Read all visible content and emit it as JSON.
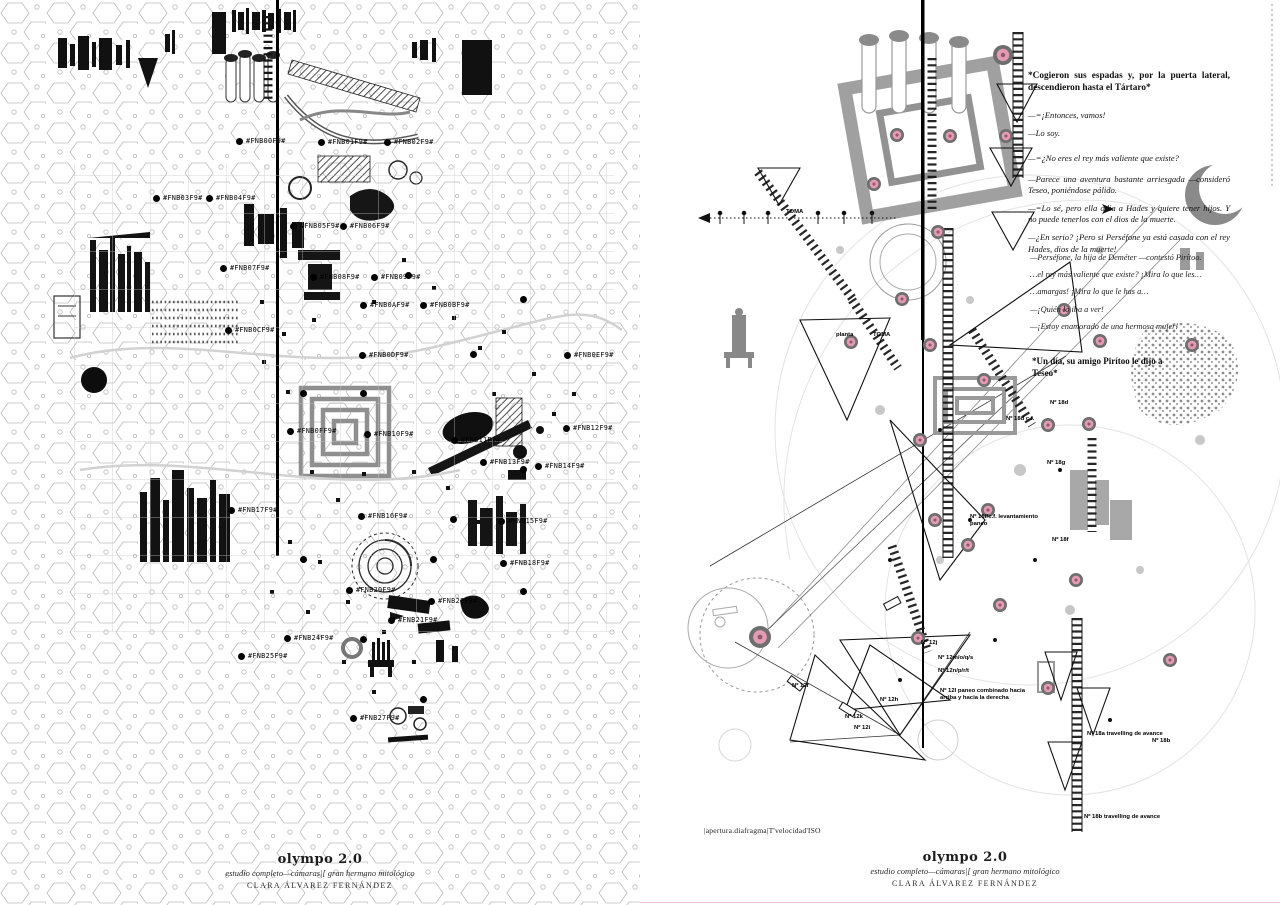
{
  "left_page": {
    "title": "olympo 2.0",
    "subtitle": "estudio completo—cámaras|[ gran hermano mitológico",
    "author": "CLARA ÁLVAREZ FERNÁNDEZ",
    "labels": [
      {
        "t": "#FNB00F9#",
        "x": 246,
        "y": 137
      },
      {
        "t": "#FNB01F9#",
        "x": 328,
        "y": 138
      },
      {
        "t": "#FNB02F9#",
        "x": 394,
        "y": 138
      },
      {
        "t": "#FNB03F9#",
        "x": 163,
        "y": 194
      },
      {
        "t": "#FNB04F9#",
        "x": 216,
        "y": 194
      },
      {
        "t": "#FNB05F9#",
        "x": 300,
        "y": 222
      },
      {
        "t": "#FNB06F9#",
        "x": 350,
        "y": 222
      },
      {
        "t": "#FNB07F9#",
        "x": 230,
        "y": 264
      },
      {
        "t": "#FNB08F9#",
        "x": 320,
        "y": 273
      },
      {
        "t": "#FNB09F9#",
        "x": 381,
        "y": 273
      },
      {
        "t": "#FNB0AF9#",
        "x": 370,
        "y": 301
      },
      {
        "t": "#FNB0BF9#",
        "x": 430,
        "y": 301
      },
      {
        "t": "#FNB0CF9#",
        "x": 235,
        "y": 326
      },
      {
        "t": "#FNB0DF9#",
        "x": 369,
        "y": 351
      },
      {
        "t": "#FNB0EF9#",
        "x": 574,
        "y": 351
      },
      {
        "t": "#FNB0FF9#",
        "x": 297,
        "y": 427
      },
      {
        "t": "#FNB10F9#",
        "x": 374,
        "y": 430
      },
      {
        "t": "#FNB11F9#",
        "x": 461,
        "y": 436
      },
      {
        "t": "#FNB12F9#",
        "x": 573,
        "y": 424
      },
      {
        "t": "#FNB13F9#",
        "x": 490,
        "y": 458
      },
      {
        "t": "#FNB14F9#",
        "x": 545,
        "y": 462
      },
      {
        "t": "#FNB15F9#",
        "x": 508,
        "y": 517
      },
      {
        "t": "#FNB16F9#",
        "x": 368,
        "y": 512
      },
      {
        "t": "#FNB17F9#",
        "x": 238,
        "y": 506
      },
      {
        "t": "#FNB18F9#",
        "x": 510,
        "y": 559
      },
      {
        "t": "#FNB20F9#",
        "x": 356,
        "y": 586
      },
      {
        "t": "#FNB21F9#",
        "x": 398,
        "y": 616
      },
      {
        "t": "#FNB23F9#",
        "x": 438,
        "y": 597
      },
      {
        "t": "#FNB24F9#",
        "x": 294,
        "y": 634
      },
      {
        "t": "#FNB25F9#",
        "x": 248,
        "y": 652
      },
      {
        "t": "#FNB27F9#",
        "x": 360,
        "y": 714
      }
    ],
    "extra_dots": [
      [
        405,
        272
      ],
      [
        470,
        351
      ],
      [
        520,
        296
      ],
      [
        450,
        516
      ],
      [
        300,
        556
      ],
      [
        430,
        556
      ],
      [
        520,
        588
      ],
      [
        360,
        636
      ],
      [
        420,
        696
      ],
      [
        520,
        466
      ],
      [
        300,
        390
      ],
      [
        360,
        390
      ]
    ]
  },
  "right_page": {
    "title": "olympo 2.0",
    "subtitle": "estudio completo—cámaras|[ gran hermano mitológico",
    "author": "CLARA ÁLVAREZ FERNÁNDEZ",
    "camera_settings_note": "|apertura.diafragma|T'velocidad'ISO",
    "quote_top": "*Cogieron sus espadas y, por la puerta lateral, descendieron hasta el Tártaro*",
    "dialogue": [
      "—=¡Entonces, vamos!",
      "—Lo soy.",
      "—=¿No eres el rey más valiente que existe?",
      "—Parece una aventura bastante arriesgada —consideró Teseo, poniéndose pálido.",
      "—=Lo sé, pero ella odia a Hades y quiere tener hijos. Y no puede tenerlos con el dios de la muerte.",
      "—¿En serio? ¡Pero si Perséfone ya está casada con el rey Hades, dios de la muerte!"
    ],
    "fragments": [
      "—Perséfone, la hija de Deméter —contestó Pirítoo.",
      "…el rey más valiente que existe? ¡Mira lo que les…",
      "…amargas! ¡Mira lo que le has a…",
      "—¡Quién lo iba a ver!",
      "—¡Estoy enamorado de una hermosa mujer!"
    ],
    "quote_mid": "*Un día, su amigo Pirítoo le dijo a Teseo*",
    "shot_labels": [
      {
        "t": "TOMA",
        "x": 146,
        "y": 209
      },
      {
        "t": "TOMA",
        "x": 233,
        "y": 332
      },
      {
        "t": "planta",
        "x": 196,
        "y": 332
      },
      {
        "t": "Nº 18d c.f.",
        "x": 366,
        "y": 416
      },
      {
        "t": "Nº 18g",
        "x": 407,
        "y": 460
      },
      {
        "t": "Nº 18f/c.f. levantamiento paneo",
        "x": 330,
        "y": 514,
        "w": 80
      },
      {
        "t": "Nº 18f",
        "x": 412,
        "y": 537
      },
      {
        "t": "Nº 18d",
        "x": 410,
        "y": 400
      },
      {
        "t": "Nº 12f",
        "x": 152,
        "y": 683
      },
      {
        "t": "Nº 12j",
        "x": 281,
        "y": 640
      },
      {
        "t": "Nº 12m/o/q/s",
        "x": 298,
        "y": 655
      },
      {
        "t": "Nº 12n/p/r/t",
        "x": 298,
        "y": 668
      },
      {
        "t": "Nº 12l paneo combinado hacia arriba y hacia la derecha",
        "x": 300,
        "y": 688,
        "w": 92
      },
      {
        "t": "Nº 12h",
        "x": 240,
        "y": 697
      },
      {
        "t": "Nº 12k",
        "x": 205,
        "y": 714
      },
      {
        "t": "Nº 12i",
        "x": 214,
        "y": 725
      },
      {
        "t": "Nº 18a travelling de avance",
        "x": 447,
        "y": 731
      },
      {
        "t": "Nº 18b",
        "x": 512,
        "y": 738
      },
      {
        "t": "Nº 18b travelling de avance",
        "x": 444,
        "y": 814
      }
    ],
    "camera_positions": [
      [
        363,
        55,
        10
      ],
      [
        257,
        135
      ],
      [
        310,
        136
      ],
      [
        366,
        136
      ],
      [
        234,
        184
      ],
      [
        298,
        232
      ],
      [
        262,
        299
      ],
      [
        211,
        342
      ],
      [
        290,
        345
      ],
      [
        424,
        310
      ],
      [
        460,
        341
      ],
      [
        552,
        345
      ],
      [
        344,
        380
      ],
      [
        408,
        425
      ],
      [
        449,
        424
      ],
      [
        280,
        440
      ],
      [
        295,
        520
      ],
      [
        348,
        510
      ],
      [
        328,
        545
      ],
      [
        360,
        605
      ],
      [
        436,
        580
      ],
      [
        278,
        638
      ],
      [
        530,
        660
      ],
      [
        408,
        688
      ],
      [
        120,
        637,
        11
      ]
    ]
  },
  "colors": {
    "ink": "#141414",
    "grey": "#8f8f8f",
    "pink_marker": "#e49ab2",
    "pink_rule": "#e9c4cf"
  }
}
